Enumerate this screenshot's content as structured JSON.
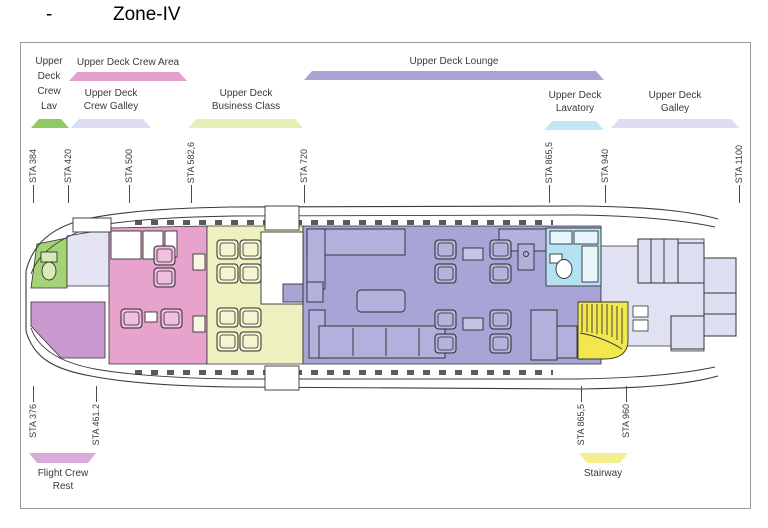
{
  "title": {
    "bullet": "-",
    "text": "Zone-IV"
  },
  "zones": {
    "crew_lav": {
      "label": "Upper\nDeck\nCrew\nLav",
      "color": "#a4d377",
      "bracket_color": "#8fca62"
    },
    "crew_area": {
      "label": "Upper Deck Crew Area",
      "color": "#e7a3cc",
      "bracket_color": "#e49fca"
    },
    "crew_galley": {
      "label": "Upper Deck\nCrew Galley",
      "color": "#e4e4f4",
      "bracket_color": "#dcdcf2"
    },
    "business": {
      "label": "Upper Deck\nBusiness Class",
      "color": "#eef0bf",
      "bracket_color": "#e9edb6"
    },
    "lounge": {
      "label": "Upper Deck Lounge",
      "color": "#a8a5d6",
      "bracket_color": "#a7a4d4"
    },
    "lavatory": {
      "label": "Upper Deck\nLavatory",
      "color": "#b5e2f2",
      "bracket_color": "#c3e8f5"
    },
    "galley": {
      "label": "Upper Deck\nGalley",
      "color": "#e0e2f3",
      "bracket_color": "#dcdcf2"
    },
    "flight_crew_rest": {
      "label": "Flight Crew\nRest",
      "color": "#cb97cf",
      "bracket_color": "#d9abdb"
    },
    "stairway": {
      "label": "Stairway",
      "color": "#f2e84d",
      "bracket_color": "#f3ef8e"
    }
  },
  "sta_top": [
    {
      "label": "STA 384"
    },
    {
      "label": "STA 420"
    },
    {
      "label": "STA 500"
    },
    {
      "label": "STA 582,6"
    },
    {
      "label": "STA 720"
    },
    {
      "label": "STA 865,5"
    },
    {
      "label": "STA 940"
    },
    {
      "label": "STA 1100"
    }
  ],
  "sta_bottom": [
    {
      "label": "STA 376"
    },
    {
      "label": "STA 461.2"
    },
    {
      "label": "STA 865,5"
    },
    {
      "label": "STA 960"
    }
  ]
}
